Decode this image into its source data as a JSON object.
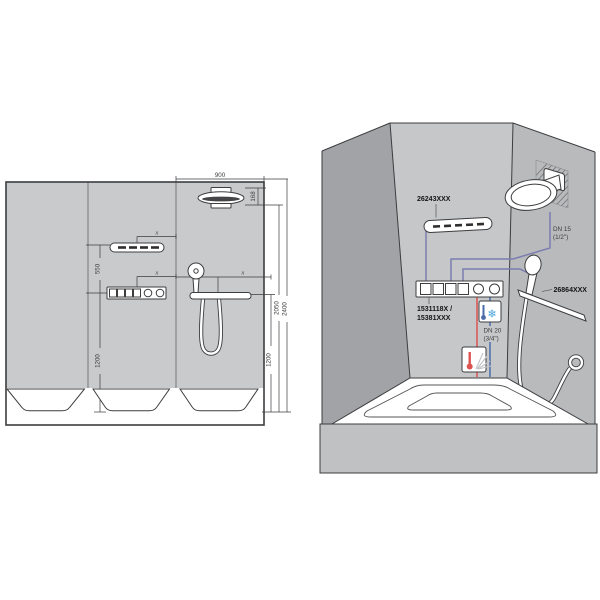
{
  "colors": {
    "pipe": "#7b7db0",
    "hot_water": "#dd5350",
    "cold_water": "#4a6cab",
    "snowflake": "#45a3d9",
    "wall_light": "#c9cacc",
    "wall_back": "#c6c7c9",
    "wall_left": "#a2a3a6",
    "wall_right": "#b9babc",
    "tub_apron": "#c0c1c3"
  },
  "left_diagram": {
    "dims": {
      "width_900": "900",
      "head_168": "168",
      "offset_550": "550",
      "height_1200_left": "1200",
      "height_1200_right": "1200",
      "height_2050": "2050",
      "height_2400": "2400",
      "x_flat_shower": "x",
      "x_valve": "x",
      "x_shelf": "x"
    }
  },
  "right_diagram": {
    "labels": {
      "shoulder_shower_code": "26243XXX",
      "valve_code_line1": "1531118X /",
      "valve_code_line2": "15381XXX",
      "hand_shower_code": "26864XXX",
      "dn15_line1": "DN 15",
      "dn15_line2": "(1/2\")",
      "dn20_line1": "DN 20",
      "dn20_line2": "(3/4\")"
    },
    "icons": {
      "snowflake": "❄"
    }
  }
}
